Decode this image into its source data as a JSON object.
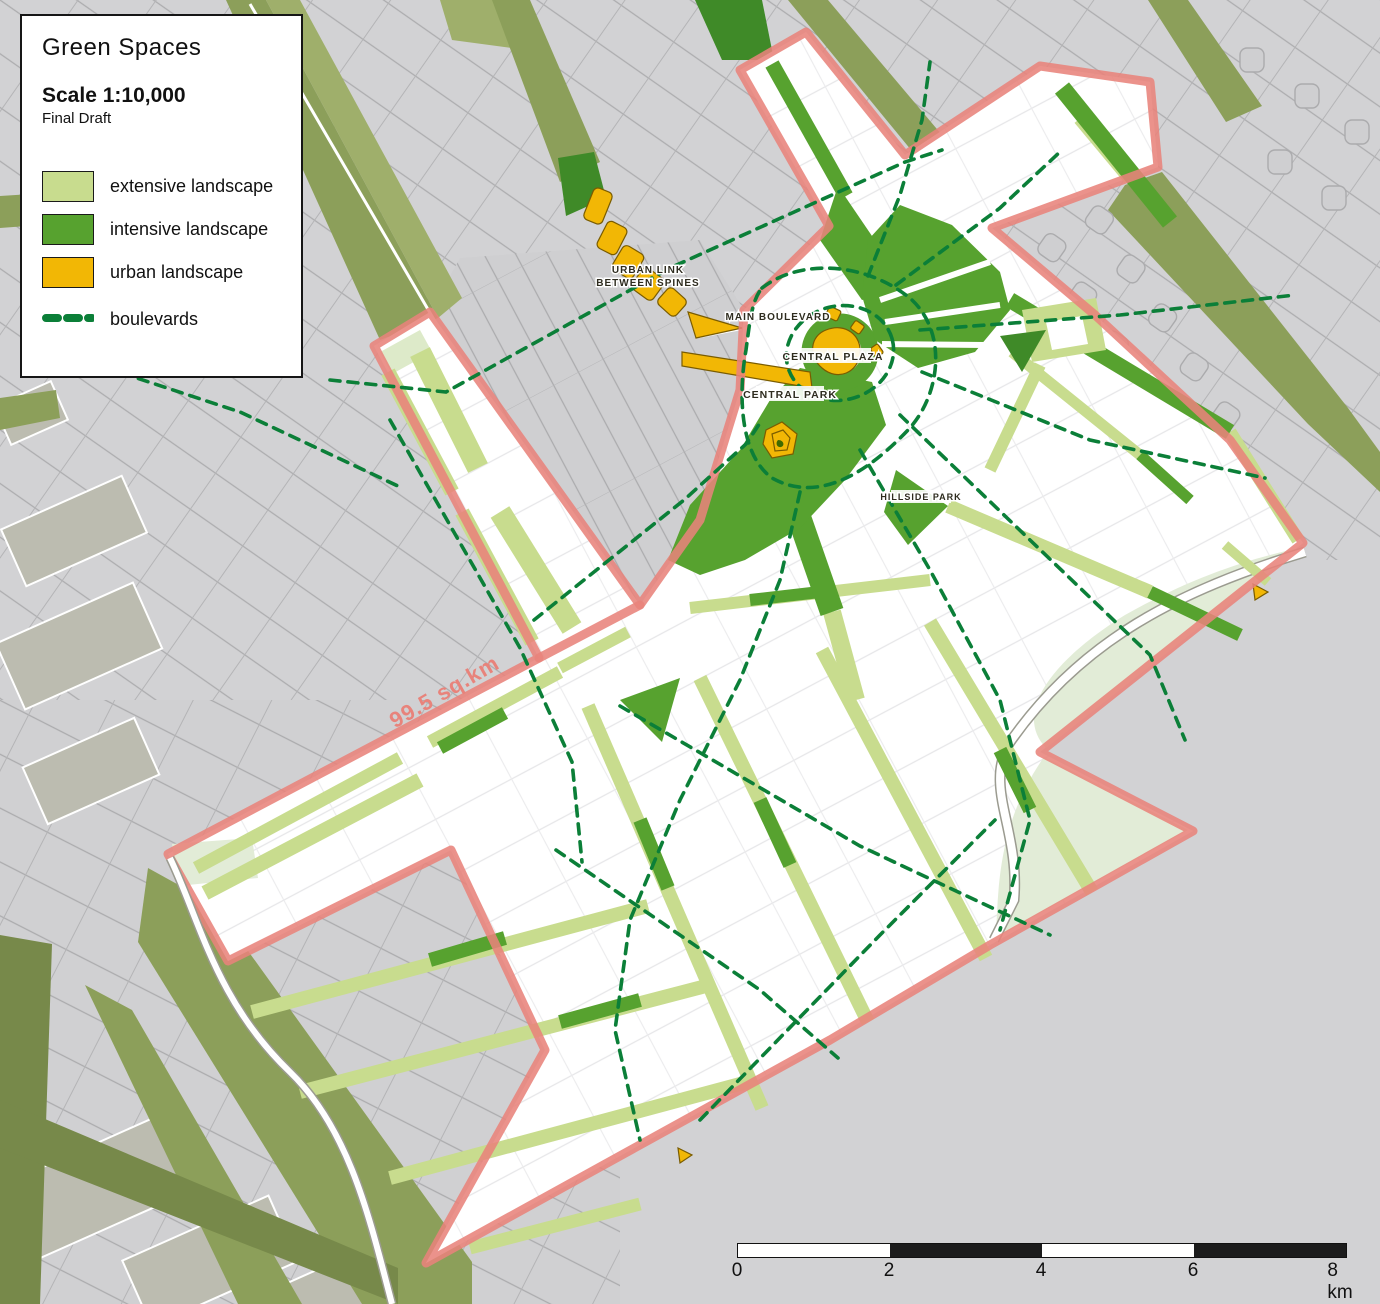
{
  "title_block": {
    "title": "Green Spaces",
    "scale": "Scale 1:10,000",
    "status": "Final Draft"
  },
  "legend": {
    "items": [
      {
        "label": "extensive landscape",
        "color": "#C8DC8E"
      },
      {
        "label": "intensive landscape",
        "color": "#57A22F"
      },
      {
        "label": "urban landscape",
        "color": "#F2B705"
      },
      {
        "label": "boulevards",
        "color": "#0B7F38"
      }
    ]
  },
  "map_labels": {
    "urban_link_line1": "URBAN LINK",
    "urban_link_line2": "BETWEEN SPINES",
    "main_boulevard": "MAIN BOULEVARD",
    "central_plaza": "CENTRAL PLAZA",
    "central_park": "CENTRAL PARK",
    "hillside_park": "HILLSIDE PARK",
    "area": "99.5 sq.km"
  },
  "scale_bar": {
    "ticks": [
      "0",
      "2",
      "4",
      "6"
    ],
    "last_tick": "8 km"
  },
  "colors": {
    "background": "#D2D2D4",
    "parcel_line": "#ACACAE",
    "olive": "#8C9F5A",
    "olive_dark": "#77894A",
    "extensive": "#C8DC8E",
    "pale_extensive": "#E2ECD7",
    "intensive": "#57A22F",
    "intensive_dark": "#3F8A28",
    "urban": "#F2B705",
    "boulevard_dash": "#0B7F38",
    "boundary": "#E8837B"
  }
}
